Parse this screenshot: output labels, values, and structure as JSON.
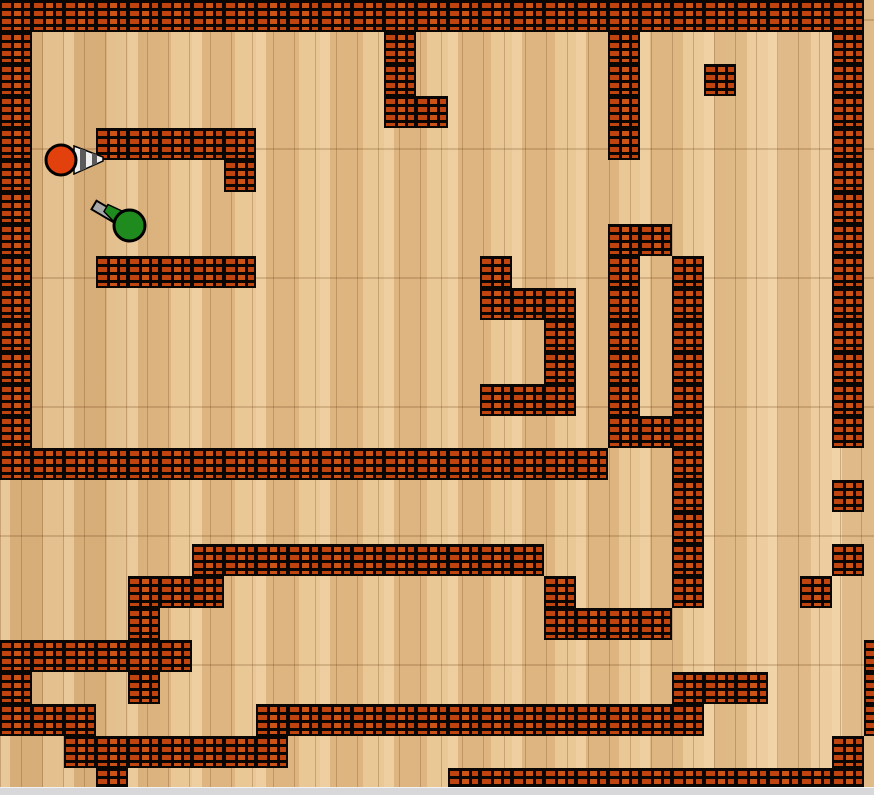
{
  "maze": {
    "cell_size": 32,
    "cols": 28,
    "rows": 25,
    "colors": {
      "brick": "#bf4410",
      "brick_alt": "#cc5216",
      "mortar": "#0a0603",
      "floor": "#e7c18c",
      "plank_line": "#a97b49",
      "bottom_strip": "#d8d8da"
    },
    "wall_cells": [
      [
        0,
        0
      ],
      [
        1,
        0
      ],
      [
        2,
        0
      ],
      [
        3,
        0
      ],
      [
        4,
        0
      ],
      [
        5,
        0
      ],
      [
        6,
        0
      ],
      [
        7,
        0
      ],
      [
        8,
        0
      ],
      [
        9,
        0
      ],
      [
        10,
        0
      ],
      [
        11,
        0
      ],
      [
        12,
        0
      ],
      [
        13,
        0
      ],
      [
        14,
        0
      ],
      [
        15,
        0
      ],
      [
        16,
        0
      ],
      [
        17,
        0
      ],
      [
        18,
        0
      ],
      [
        19,
        0
      ],
      [
        20,
        0
      ],
      [
        21,
        0
      ],
      [
        22,
        0
      ],
      [
        23,
        0
      ],
      [
        24,
        0
      ],
      [
        25,
        0
      ],
      [
        0,
        1
      ],
      [
        0,
        2
      ],
      [
        0,
        3
      ],
      [
        0,
        4
      ],
      [
        0,
        5
      ],
      [
        0,
        6
      ],
      [
        0,
        7
      ],
      [
        0,
        8
      ],
      [
        0,
        9
      ],
      [
        0,
        10
      ],
      [
        0,
        11
      ],
      [
        0,
        12
      ],
      [
        0,
        13
      ],
      [
        0,
        14
      ],
      [
        26,
        0
      ],
      [
        26,
        1
      ],
      [
        26,
        2
      ],
      [
        26,
        3
      ],
      [
        26,
        4
      ],
      [
        26,
        5
      ],
      [
        26,
        6
      ],
      [
        26,
        7
      ],
      [
        26,
        8
      ],
      [
        26,
        9
      ],
      [
        26,
        10
      ],
      [
        26,
        11
      ],
      [
        26,
        12
      ],
      [
        26,
        13
      ],
      [
        26,
        15
      ],
      [
        26,
        17
      ],
      [
        26,
        23
      ],
      [
        12,
        1
      ],
      [
        12,
        2
      ],
      [
        12,
        3
      ],
      [
        13,
        3
      ],
      [
        3,
        4
      ],
      [
        4,
        4
      ],
      [
        5,
        4
      ],
      [
        6,
        4
      ],
      [
        7,
        4
      ],
      [
        7,
        5
      ],
      [
        3,
        8
      ],
      [
        4,
        8
      ],
      [
        5,
        8
      ],
      [
        6,
        8
      ],
      [
        7,
        8
      ],
      [
        19,
        1
      ],
      [
        19,
        2
      ],
      [
        19,
        3
      ],
      [
        19,
        4
      ],
      [
        22,
        2
      ],
      [
        19,
        7
      ],
      [
        20,
        7
      ],
      [
        19,
        8
      ],
      [
        19,
        9
      ],
      [
        19,
        10
      ],
      [
        19,
        11
      ],
      [
        19,
        12
      ],
      [
        19,
        13
      ],
      [
        20,
        13
      ],
      [
        21,
        8
      ],
      [
        21,
        9
      ],
      [
        21,
        10
      ],
      [
        21,
        11
      ],
      [
        21,
        12
      ],
      [
        21,
        13
      ],
      [
        21,
        14
      ],
      [
        21,
        15
      ],
      [
        21,
        16
      ],
      [
        21,
        17
      ],
      [
        21,
        18
      ],
      [
        15,
        8
      ],
      [
        15,
        9
      ],
      [
        16,
        9
      ],
      [
        17,
        9
      ],
      [
        17,
        10
      ],
      [
        17,
        11
      ],
      [
        15,
        12
      ],
      [
        16,
        12
      ],
      [
        17,
        12
      ],
      [
        1,
        14
      ],
      [
        2,
        14
      ],
      [
        3,
        14
      ],
      [
        4,
        14
      ],
      [
        5,
        14
      ],
      [
        6,
        14
      ],
      [
        7,
        14
      ],
      [
        8,
        14
      ],
      [
        9,
        14
      ],
      [
        10,
        14
      ],
      [
        11,
        14
      ],
      [
        12,
        14
      ],
      [
        13,
        14
      ],
      [
        14,
        14
      ],
      [
        15,
        14
      ],
      [
        16,
        14
      ],
      [
        17,
        14
      ],
      [
        18,
        14
      ],
      [
        6,
        17
      ],
      [
        7,
        17
      ],
      [
        8,
        17
      ],
      [
        9,
        17
      ],
      [
        10,
        17
      ],
      [
        11,
        17
      ],
      [
        12,
        17
      ],
      [
        13,
        17
      ],
      [
        14,
        17
      ],
      [
        15,
        17
      ],
      [
        16,
        17
      ],
      [
        17,
        18
      ],
      [
        17,
        19
      ],
      [
        18,
        19
      ],
      [
        19,
        19
      ],
      [
        20,
        19
      ],
      [
        4,
        18
      ],
      [
        5,
        18
      ],
      [
        6,
        18
      ],
      [
        4,
        19
      ],
      [
        4,
        20
      ],
      [
        4,
        21
      ],
      [
        0,
        20
      ],
      [
        1,
        20
      ],
      [
        2,
        20
      ],
      [
        3,
        20
      ],
      [
        5,
        20
      ],
      [
        0,
        21
      ],
      [
        0,
        22
      ],
      [
        1,
        22
      ],
      [
        2,
        22
      ],
      [
        8,
        22
      ],
      [
        9,
        22
      ],
      [
        10,
        22
      ],
      [
        11,
        22
      ],
      [
        12,
        22
      ],
      [
        13,
        22
      ],
      [
        14,
        22
      ],
      [
        15,
        22
      ],
      [
        16,
        22
      ],
      [
        17,
        22
      ],
      [
        18,
        22
      ],
      [
        19,
        22
      ],
      [
        20,
        22
      ],
      [
        21,
        22
      ],
      [
        2,
        23
      ],
      [
        3,
        23
      ],
      [
        4,
        23
      ],
      [
        5,
        23
      ],
      [
        6,
        23
      ],
      [
        7,
        23
      ],
      [
        8,
        23
      ],
      [
        3,
        24
      ],
      [
        25,
        18
      ],
      [
        21,
        21
      ],
      [
        22,
        21
      ],
      [
        23,
        21
      ],
      [
        14,
        24
      ],
      [
        15,
        24
      ],
      [
        16,
        24
      ],
      [
        17,
        24
      ],
      [
        18,
        24
      ],
      [
        19,
        24
      ],
      [
        20,
        24
      ],
      [
        21,
        24
      ],
      [
        22,
        24
      ],
      [
        23,
        24
      ],
      [
        24,
        24
      ],
      [
        25,
        24
      ],
      [
        26,
        24
      ],
      [
        27,
        20
      ],
      [
        27,
        21
      ],
      [
        27,
        22
      ]
    ]
  },
  "tanks": {
    "red": {
      "name": "red tank",
      "color": "#e2400c",
      "outline": "#000000",
      "cx": 61,
      "cy": 160,
      "r": 15,
      "barrel_direction_deg": 0,
      "cone_outer": {
        "points": "74,146 103,157 103,161 74,174",
        "fill": "#ededed"
      },
      "cone_stripe1": {
        "points": "80,148.3 86,150.6 86,168.6 80,171.3",
        "fill": "#5a5a5a"
      },
      "cone_stripe2": {
        "points": "92,152.8 97,154.7 97,163.7 92,165.9",
        "fill": "#5a5a5a"
      }
    },
    "green": {
      "name": "green tank",
      "color": "#1f8b1f",
      "outline": "#000000",
      "cx": 129.5,
      "cy": 225.5,
      "r": 15.5,
      "barrel_direction_deg": 210,
      "barrel": {
        "points": "119.5,214.2 96.5,200.7 91.5,209.3 114.5,222.8",
        "fill": "#a8a8a8"
      },
      "nose": {
        "points": "108,204.5 124,212 117,225 104,211.5",
        "fill": "#1f8b1f"
      }
    }
  },
  "window": {
    "bottom_strip_color": "#d8d8da"
  }
}
